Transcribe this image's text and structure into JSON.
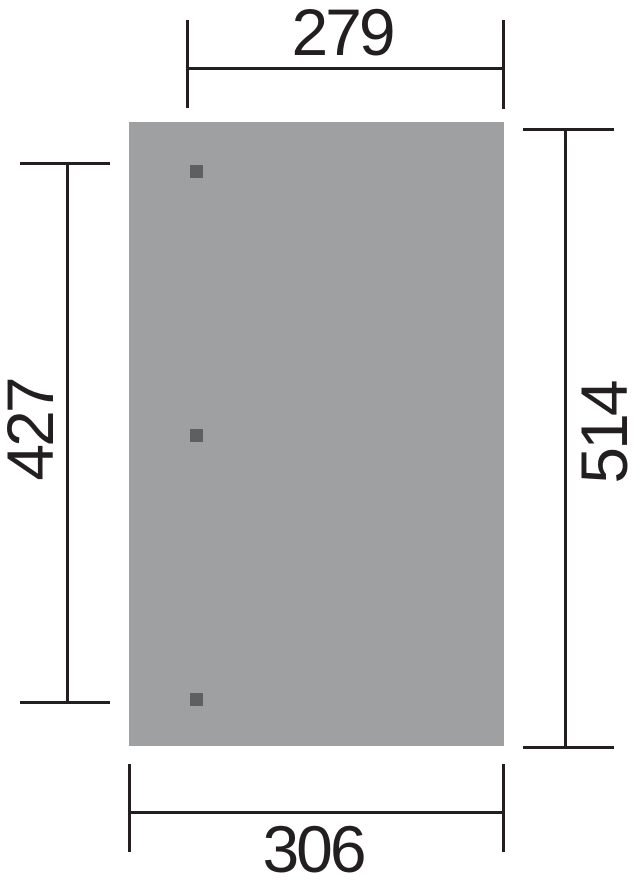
{
  "figure": {
    "type": "dimension-drawing",
    "colors": {
      "ink": "#231f20",
      "panel": "#9fa0a2",
      "post": "#5e5f61",
      "background": "#ffffff"
    },
    "panel": {
      "x": 129,
      "y": 122,
      "width": 375,
      "height": 624
    },
    "posts": {
      "size": 13,
      "items": [
        {
          "x": 190,
          "y": 165
        },
        {
          "x": 190,
          "y": 429
        },
        {
          "x": 190,
          "y": 693
        }
      ]
    },
    "dimensions": {
      "top": {
        "value": "279"
      },
      "bottom": {
        "value": "306"
      },
      "left": {
        "value": "427"
      },
      "right": {
        "value": "514"
      }
    }
  }
}
